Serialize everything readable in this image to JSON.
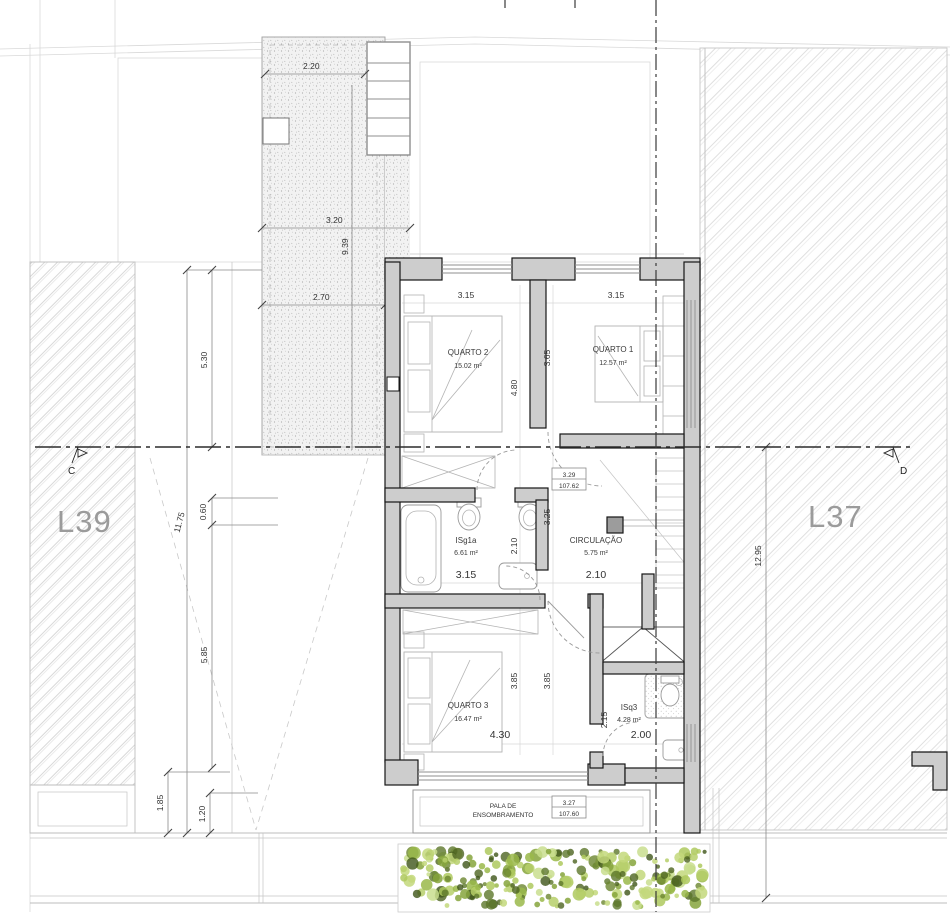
{
  "drawing": {
    "type": "architectural floor plan (upper floor)",
    "plot_labels": {
      "left": "L39",
      "right": "L37"
    },
    "section_markers": {
      "left": "C",
      "right": "D"
    },
    "rooms": [
      {
        "name": "QUARTO 2",
        "area": "15.02 m²"
      },
      {
        "name": "QUARTO 1",
        "area": "12.57 m²"
      },
      {
        "name": "ISg1a",
        "area": "6.61 m²"
      },
      {
        "name": "CIRCULAÇÃO",
        "area": "5.75 m²"
      },
      {
        "name": "QUARTO 3",
        "area": "16.47 m²"
      },
      {
        "name": "ISq3",
        "area": "4.28 m²"
      }
    ],
    "levels": [
      {
        "value": "3.29",
        "elevation": "107.62"
      },
      {
        "value": "3.27",
        "elevation": "107.60"
      }
    ],
    "annotations": {
      "pala_line1": "PALA DE",
      "pala_line2": "ENSOMBRAMENTO"
    },
    "dims": {
      "c220": "2.20",
      "c320": "3.20",
      "c939": "9.39",
      "c270": "2.70",
      "l530": "5.30",
      "l1175": "11.75",
      "l060": "0.60",
      "l585": "5.85",
      "l185": "1.85",
      "l120": "1.20",
      "r1295": "12.95",
      "q2w": "3.15",
      "q1w": "3.15",
      "q2h": "4.80",
      "q1h": "3.65",
      "mid325": "3.25",
      "bathw": "3.15",
      "bathh": "2.10",
      "circw": "2.10",
      "q3h1": "3.85",
      "q3h2": "3.85",
      "q3w": "4.30",
      "isq3h": "2.15",
      "isq3w": "2.00"
    },
    "colors": {
      "wall": "#cdcdcd",
      "hedge_green": "#9fbf4e",
      "label_gray": "#9b9b9b"
    }
  }
}
